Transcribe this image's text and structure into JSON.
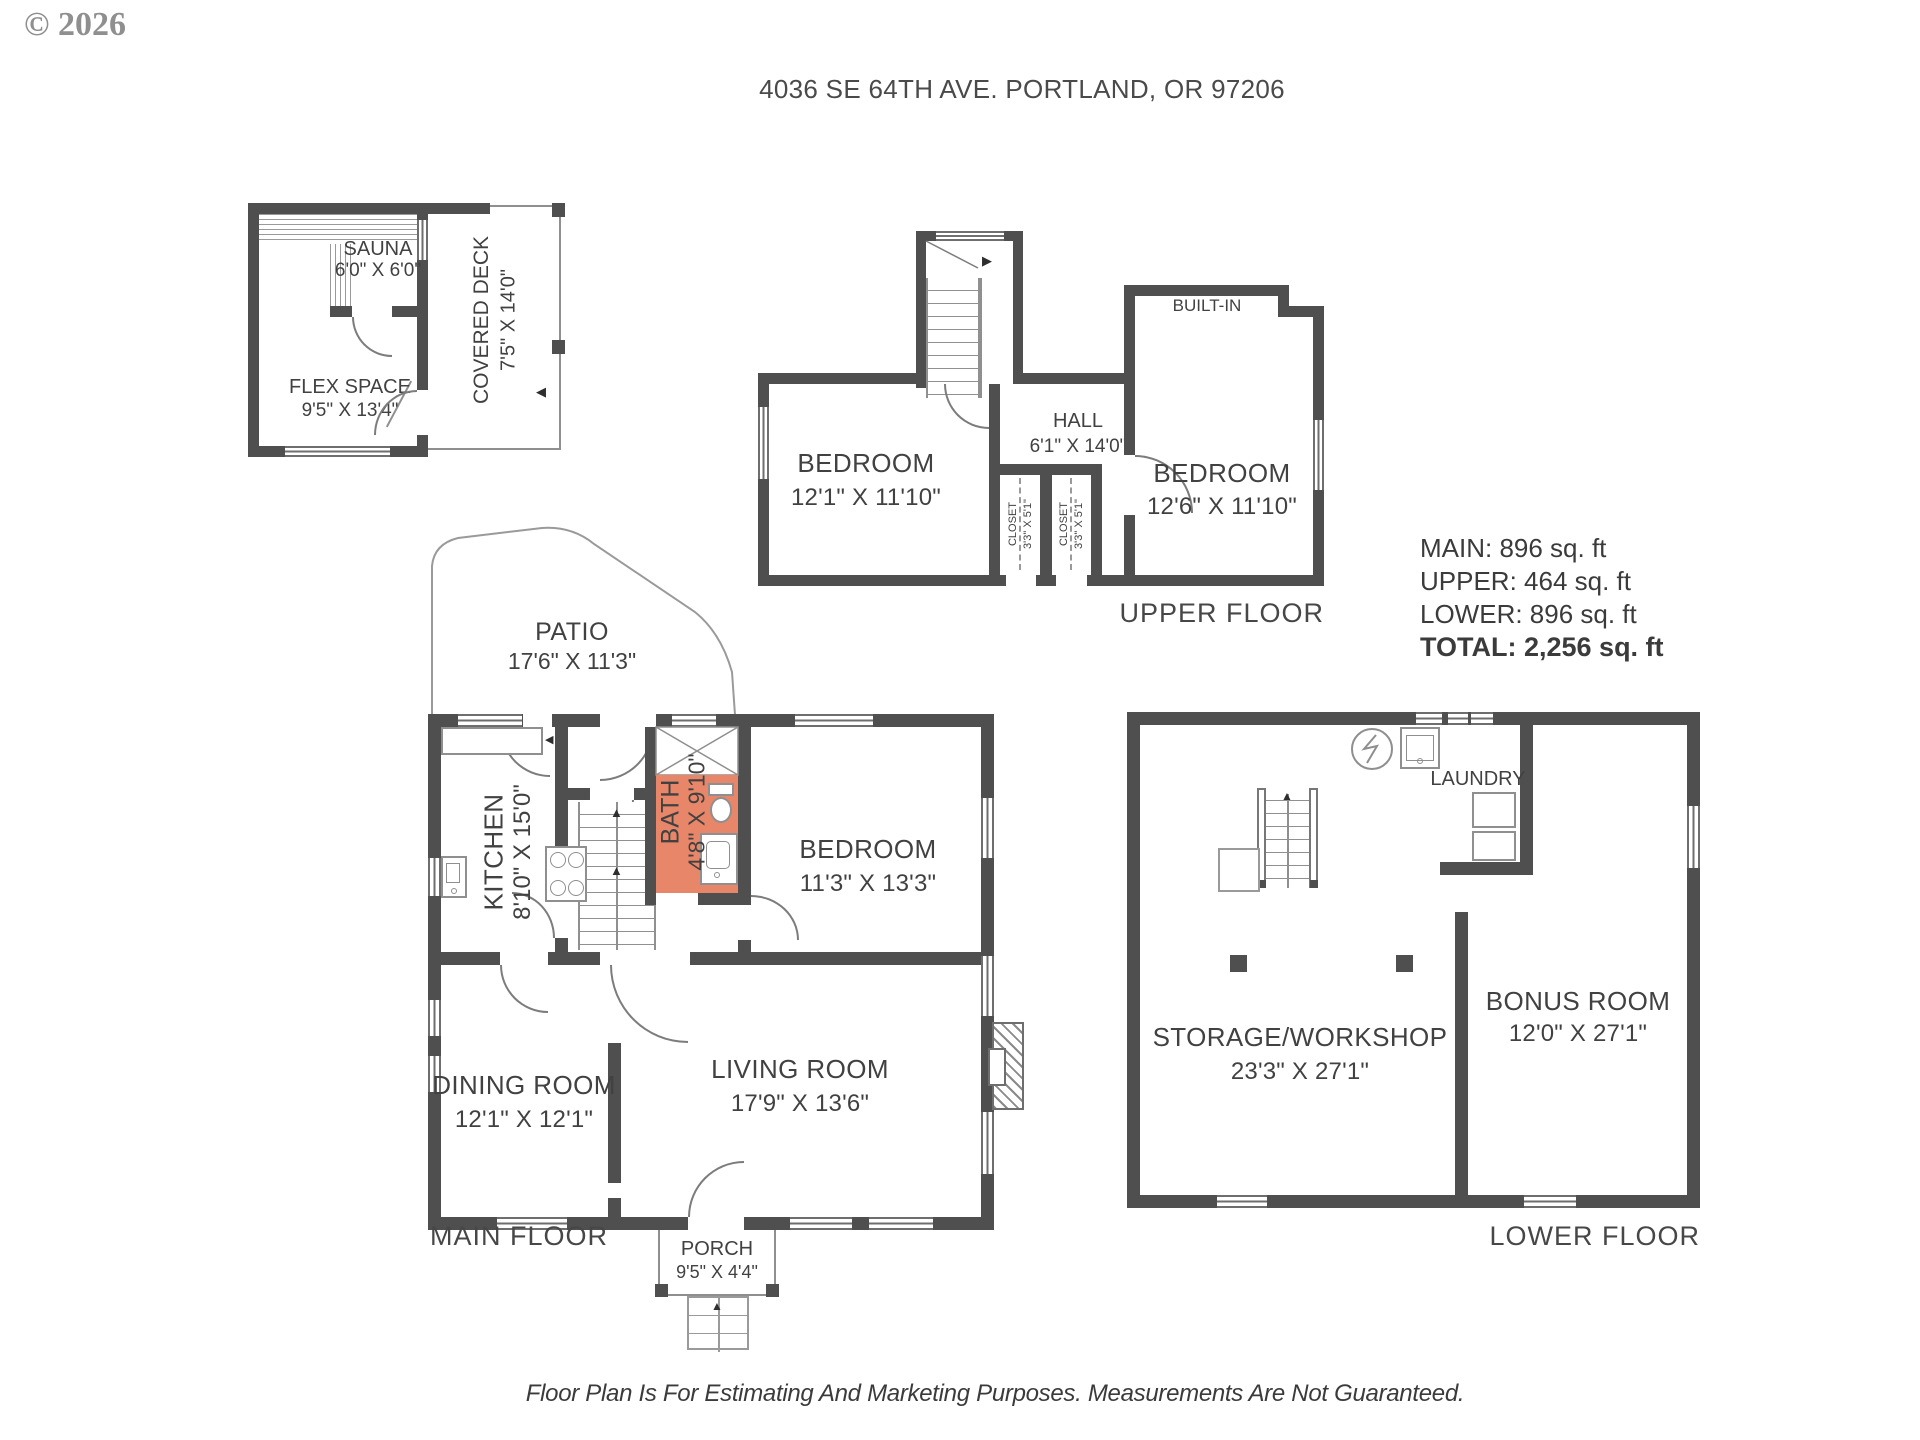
{
  "watermark": "© 2026",
  "title": "4036 SE 64TH AVE. PORTLAND, OR 97206",
  "disclaimer": "Floor Plan Is For Estimating And Marketing Purposes. Measurements Are Not Guaranteed.",
  "colors": {
    "wall": "#4f4f4f",
    "text": "#414141",
    "line": "#8f8f8f",
    "bath_highlight": "#e8866a",
    "watermark": "#8f8f8f"
  },
  "annex": {
    "sauna_name": "SAUNA",
    "sauna_dims": "6'0\" X 6'0\"",
    "flex_name": "FLEX SPACE",
    "flex_dims": "9'5\" X 13'4\"",
    "deck_name": "COVERED DECK",
    "deck_dims": "7'5\" X 14'0\""
  },
  "upper": {
    "floor_label": "UPPER FLOOR",
    "bedroom_left_name": "BEDROOM",
    "bedroom_left_dims": "12'1\" X 11'10\"",
    "bedroom_right_name": "BEDROOM",
    "bedroom_right_dims": "12'6\" X 11'10\"",
    "hall_name": "HALL",
    "hall_dims": "6'1\" X 14'0\"",
    "closet1_name": "CLOSET",
    "closet1_dims": "3'3\" X 5'1\"",
    "closet2_name": "CLOSET",
    "closet2_dims": "3'3\" X 5'1\"",
    "builtin_label": "BUILT-IN"
  },
  "area_summary": {
    "main": "MAIN: 896 sq. ft",
    "upper": "UPPER: 464 sq. ft",
    "lower": "LOWER: 896 sq. ft",
    "total": "TOTAL: 2,256 sq. ft"
  },
  "main_floor": {
    "floor_label": "MAIN FLOOR",
    "patio_name": "PATIO",
    "patio_dims": "17'6\" X 11'3\"",
    "kitchen_name": "KITCHEN",
    "kitchen_dims": "8'10\" X 15'0\"",
    "bath_name": "BATH",
    "bath_dims": "4'8\" X 9'10\"",
    "bedroom_name": "BEDROOM",
    "bedroom_dims": "11'3\" X 13'3\"",
    "dining_name": "DINING ROOM",
    "dining_dims": "12'1\" X 12'1\"",
    "living_name": "LIVING ROOM",
    "living_dims": "17'9\" X 13'6\"",
    "porch_name": "PORCH",
    "porch_dims": "9'5\" X 4'4\""
  },
  "lower_floor": {
    "floor_label": "LOWER FLOOR",
    "laundry_label": "LAUNDRY",
    "storage_name": "STORAGE/WORKSHOP",
    "storage_dims": "23'3\" X 27'1\"",
    "bonus_name": "BONUS ROOM",
    "bonus_dims": "12'0\" X 27'1\""
  }
}
